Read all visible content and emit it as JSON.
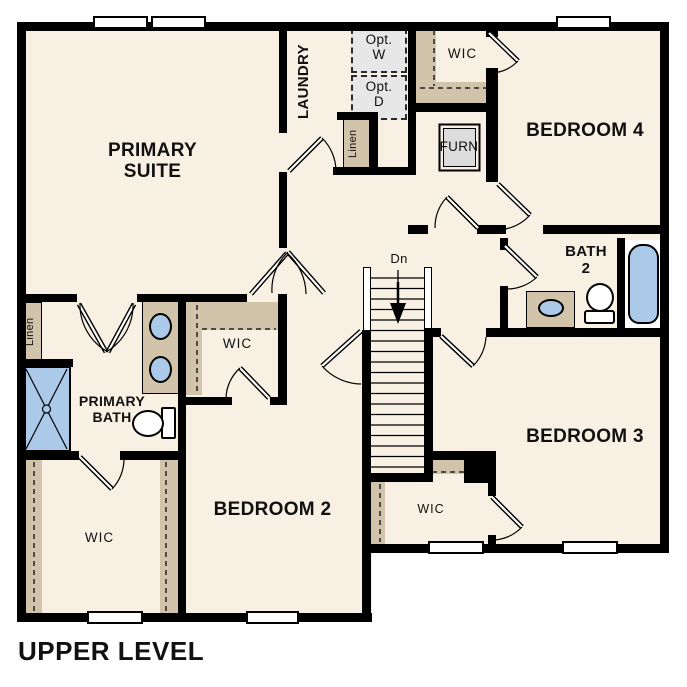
{
  "page_title": "UPPER LEVEL",
  "colors": {
    "floor": "#f8f0e2",
    "casework_tan": "#d2c4aa",
    "fixture_blue": "#abc9e9",
    "optional_gray": "#e7e7e7",
    "wall": "#000000",
    "text": "#111111"
  },
  "rooms": {
    "primary_suite": "PRIMARY SUITE",
    "laundry": "LAUNDRY",
    "bedroom4": "BEDROOM 4",
    "bath2": "BATH 2",
    "bedroom3": "BEDROOM 3",
    "bedroom2": "BEDROOM 2",
    "primary_bath": "PRIMARY BATH",
    "wic_bedroom4": "WIC",
    "wic_primary": "WIC",
    "wic_bedroom2": "WIC",
    "wic_bedroom3": "WIC",
    "linen_upper": "Linen",
    "linen_hall": "Linen"
  },
  "annotations": {
    "stairs_down": "Dn",
    "furnace": "FURN",
    "optional_washer": "Opt. W",
    "optional_dryer": "Opt. D"
  },
  "fixtures": [
    "shower",
    "double-vanity-sinks",
    "toilet-primary-bath",
    "vanity-sink-bath2",
    "toilet-bath2",
    "bathtub",
    "stairs",
    "windows",
    "door-swings",
    "closet-rods"
  ]
}
